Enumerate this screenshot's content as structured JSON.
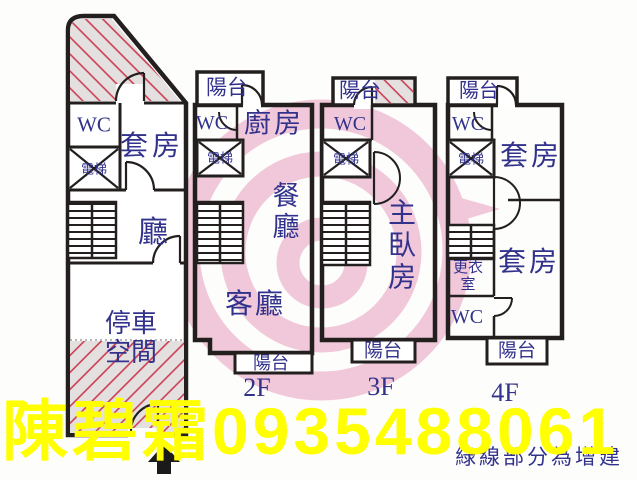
{
  "colors": {
    "wall": "#241f1f",
    "label_blue": "#32328c",
    "hatch_fill": "#e4e0e0",
    "hatch_line": "#cb4055",
    "watermark_pink": "#f0c8da",
    "contact_yellow": "#ffff00"
  },
  "plans": {
    "f1": {
      "wc": "WC",
      "elevator": "電梯",
      "suite": "套房",
      "hall": "廳",
      "parking": "停車空間"
    },
    "f2": {
      "balcony_top": "陽台",
      "wc": "WC",
      "kitchen": "廚房",
      "elevator": "電梯",
      "dining": "餐廳",
      "living": "客廳",
      "balcony_bottom": "陽台",
      "floor_label": "2F"
    },
    "f3": {
      "balcony_top": "陽台",
      "wc": "WC",
      "elevator": "電梯",
      "master_bedroom": "主臥房",
      "balcony_bottom": "陽台",
      "floor_label": "3F"
    },
    "f4": {
      "balcony_top": "陽台",
      "wc_top": "WC",
      "elevator": "電梯",
      "suite_top": "套房",
      "dressing_room": "更衣室",
      "wc_bottom": "WC",
      "suite_bottom": "套房",
      "balcony_bottom": "陽台",
      "floor_label": "4F"
    }
  },
  "overlay": {
    "contact": "陳碧霜0935488061",
    "note": "綠線部分為增建"
  }
}
